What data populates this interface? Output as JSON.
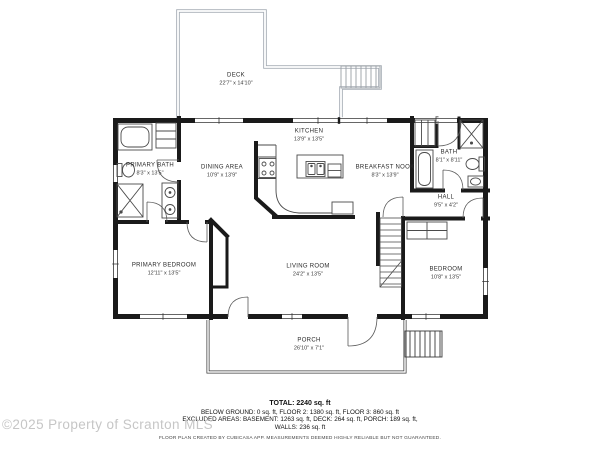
{
  "rooms": [
    {
      "name": "DECK",
      "dims": "22'7\" x 14'10\""
    },
    {
      "name": "KITCHEN",
      "dims": "13'9\" x 13'5\""
    },
    {
      "name": "PRIMARY BATH",
      "dims": "8'3\" x 13'5\""
    },
    {
      "name": "DINING AREA",
      "dims": "10'9\" x 13'9\""
    },
    {
      "name": "BREAKFAST NOOK",
      "dims": "8'3\" x 13'9\""
    },
    {
      "name": "BATH",
      "dims": "8'1\" x 8'11\""
    },
    {
      "name": "HALL",
      "dims": "9'5\" x 4'2\""
    },
    {
      "name": "PRIMARY BEDROOM",
      "dims": "12'11\" x 13'5\""
    },
    {
      "name": "LIVING ROOM",
      "dims": "24'2\" x 13'5\""
    },
    {
      "name": "BEDROOM",
      "dims": "10'8\" x 13'5\""
    },
    {
      "name": "PORCH",
      "dims": "26'10\" x 7'1\""
    }
  ],
  "summary": {
    "total": "TOTAL: 2240 sq. ft",
    "line1": "BELOW GROUND: 0 sq. ft, FLOOR 2: 1380 sq. ft, FLOOR 3: 860 sq. ft",
    "line2": "EXCLUDED AREAS: BASEMENT: 1263 sq. ft, DECK: 264 sq. ft, PORCH: 189 sq. ft,",
    "line3": "WALLS: 236 sq. ft",
    "disclaimer": "FLOOR PLAN CREATED BY CUBICASA APP. MEASUREMENTS DEEMED HIGHLY RELIABLE BUT NOT GUARANTEED."
  },
  "watermark": "©2025 Property of Scranton MLS",
  "colors": {
    "walls": "#1a1a1a",
    "fixtures": "#4a4a4a",
    "deck_rail": "#a7adb5",
    "watermark": "#c6c6c6"
  }
}
